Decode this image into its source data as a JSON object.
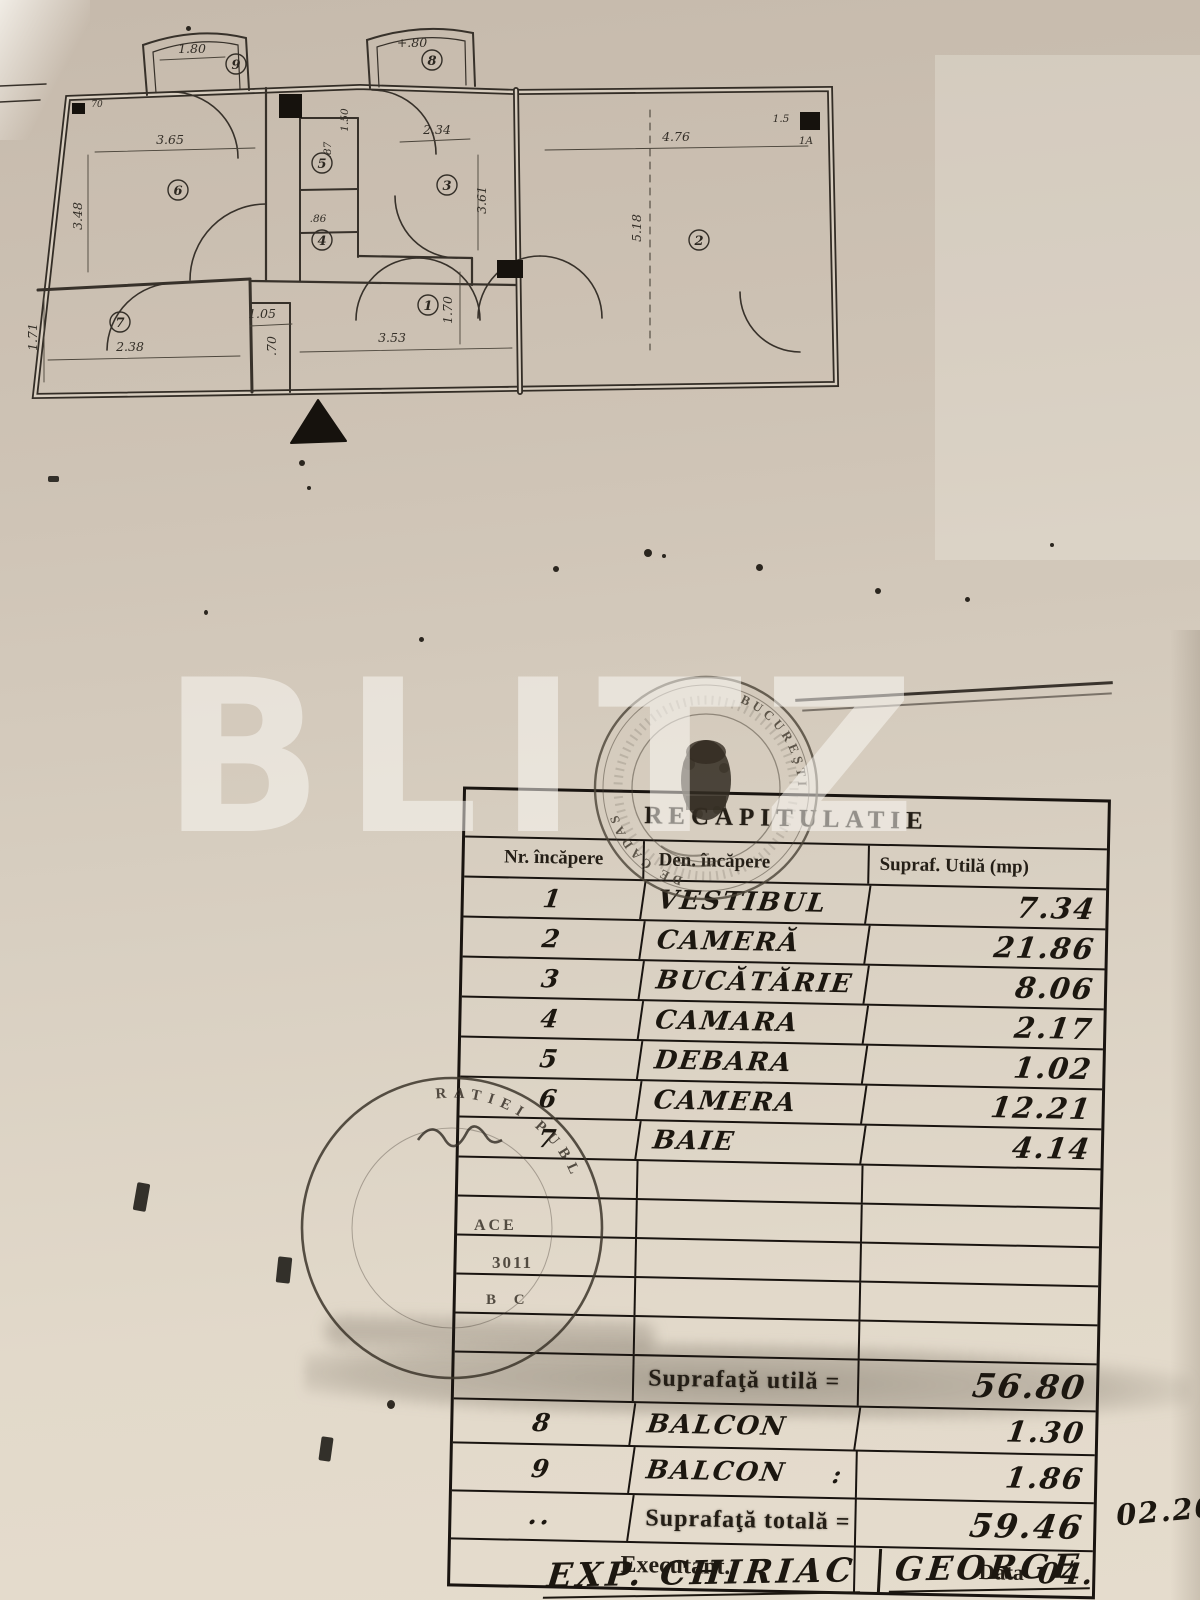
{
  "watermark": "BLITZ",
  "plan": {
    "rooms": {
      "r1": "1",
      "r2": "2",
      "r3": "3",
      "r4": "4",
      "r5": "5",
      "r6": "6",
      "r7": "7",
      "r8": "8",
      "r9": "9"
    },
    "dims": {
      "room6_width": "3.65",
      "room6_height": "3.48",
      "bath_width": "2.38",
      "bath_height": "1.71",
      "hall_width": "1.05",
      "hall_small": ".70",
      "hall_length": "3.53",
      "hall_height": "1.70",
      "kitchen_width": "2.34",
      "kitchen_height": "3.61",
      "shaft_width": ".87",
      "shaft_height": "1.50",
      "camara_dim": ".86",
      "room2_width": "4.76",
      "room2_height": "5.18",
      "balcony9_width": "1.80",
      "balcony8_width": "+.80",
      "corner_note_a": "1.5",
      "corner_note_b": "1A",
      "wall_note": "70"
    }
  },
  "table": {
    "title": "RECAPITULATIE",
    "columns": {
      "nr": "Nr. încăpere",
      "den": "Den. încăpere",
      "supraf": "Supraf. Utilă (mp)"
    },
    "rows": [
      {
        "nr": "1",
        "den": "VESTIBUL",
        "val": "7.34"
      },
      {
        "nr": "2",
        "den": "CAMERĂ",
        "val": "21.86"
      },
      {
        "nr": "3",
        "den": "BUCĂTĂRIE",
        "val": "8.06"
      },
      {
        "nr": "4",
        "den": "CAMARA",
        "val": "2.17"
      },
      {
        "nr": "5",
        "den": "DEBARA",
        "val": "1.02"
      },
      {
        "nr": "6",
        "den": "CAMERA",
        "val": "12.21"
      },
      {
        "nr": "7",
        "den": "BAIE",
        "val": "4.14"
      }
    ],
    "subtotal": {
      "label": "Suprafaţă utilă =",
      "value": "56.80"
    },
    "balcony_rows": [
      {
        "nr": "8",
        "den": "BALCON",
        "mark": "",
        "val": "1.30"
      },
      {
        "nr": "9",
        "den": "BALCON",
        "mark": ":",
        "val": "1.86"
      }
    ],
    "total": {
      "nr_mark": "..",
      "label": "Suprafaţă totală =",
      "value": "59.46"
    },
    "footer": {
      "executant": "Executant.",
      "data_label": "Data",
      "date": "04.",
      "date_cont": "02.20"
    }
  },
  "signature": {
    "left": "EXP. CHIRIAC",
    "right": "GEORGE"
  },
  "stamps": {
    "top": {
      "arc_text_1": "BUCUREŞTI",
      "arc_text_2": "DE CADAS"
    },
    "left": {
      "arc_text": "RATIEI  PUBL",
      "line_1": "ACE",
      "line_2": "3011",
      "line_3": "B C"
    }
  }
}
